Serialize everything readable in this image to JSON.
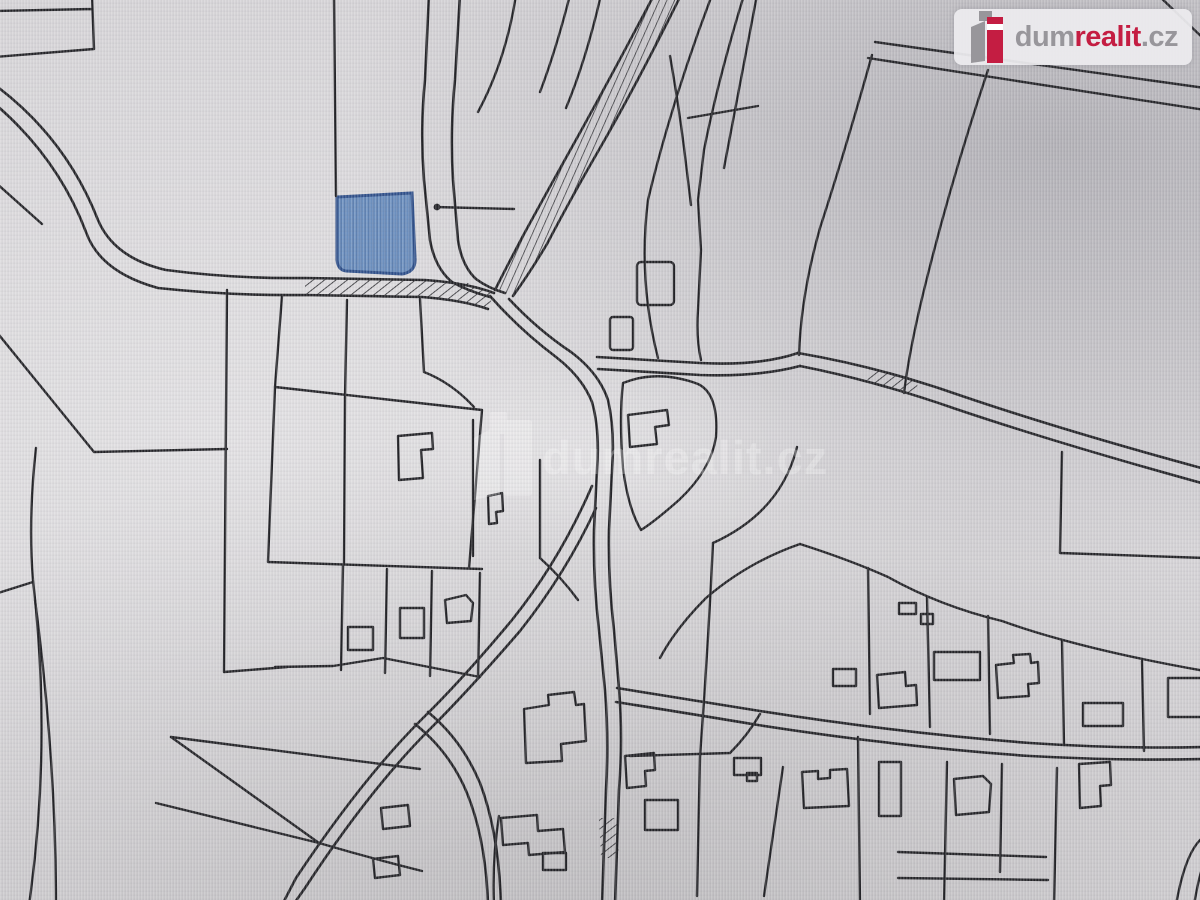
{
  "page": {
    "type": "cadastral-map-screenshot"
  },
  "brand": {
    "logo_prefix": "dum",
    "logo_highlight": "realit",
    "logo_suffix": ".cz",
    "accent_color": "#c41d42",
    "gray_color": "#98969b"
  },
  "watermark": {
    "text": "dumrealit.cz",
    "opacity": "0.27"
  },
  "map": {
    "background_color": "#d6d4d7",
    "line_color": "#202024",
    "highlighted_parcel": {
      "fill_color": "#6c90c0",
      "border_color": "#2e4f8a"
    }
  }
}
